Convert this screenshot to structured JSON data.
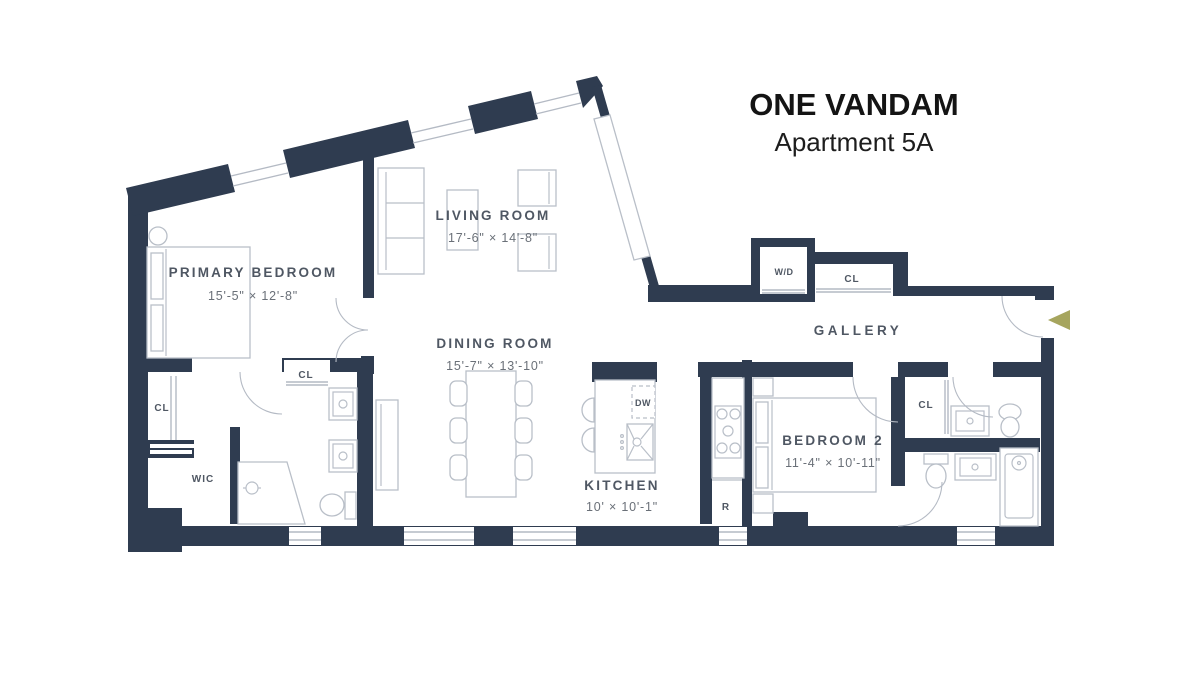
{
  "title": {
    "building": "ONE VANDAM",
    "apartment": "Apartment 5A"
  },
  "rooms": {
    "living_room": {
      "name": "LIVING ROOM",
      "dims": "17'-6\" × 14'-8\""
    },
    "primary_bedroom": {
      "name": "PRIMARY BEDROOM",
      "dims": "15'-5\" × 12'-8\""
    },
    "dining_room": {
      "name": "DINING ROOM",
      "dims": "15'-7\" × 13'-10\""
    },
    "kitchen": {
      "name": "KITCHEN",
      "dims": "10' × 10'-1\""
    },
    "bedroom_2": {
      "name": "BEDROOM 2",
      "dims": "11'-4\" × 10'-11\""
    },
    "gallery": {
      "name": "GALLERY"
    }
  },
  "labels": {
    "washer_dryer": "W/D",
    "closet": "CL",
    "walk_in_closet": "WIC",
    "dishwasher": "DW",
    "refrigerator": "R"
  },
  "colors": {
    "wall": "#2f3c50",
    "fixture_line": "#b9bfc8",
    "label_text": "#4f5763",
    "dimension_text": "#6a7078",
    "entry_accent": "#a6a55e",
    "background": "#ffffff"
  }
}
